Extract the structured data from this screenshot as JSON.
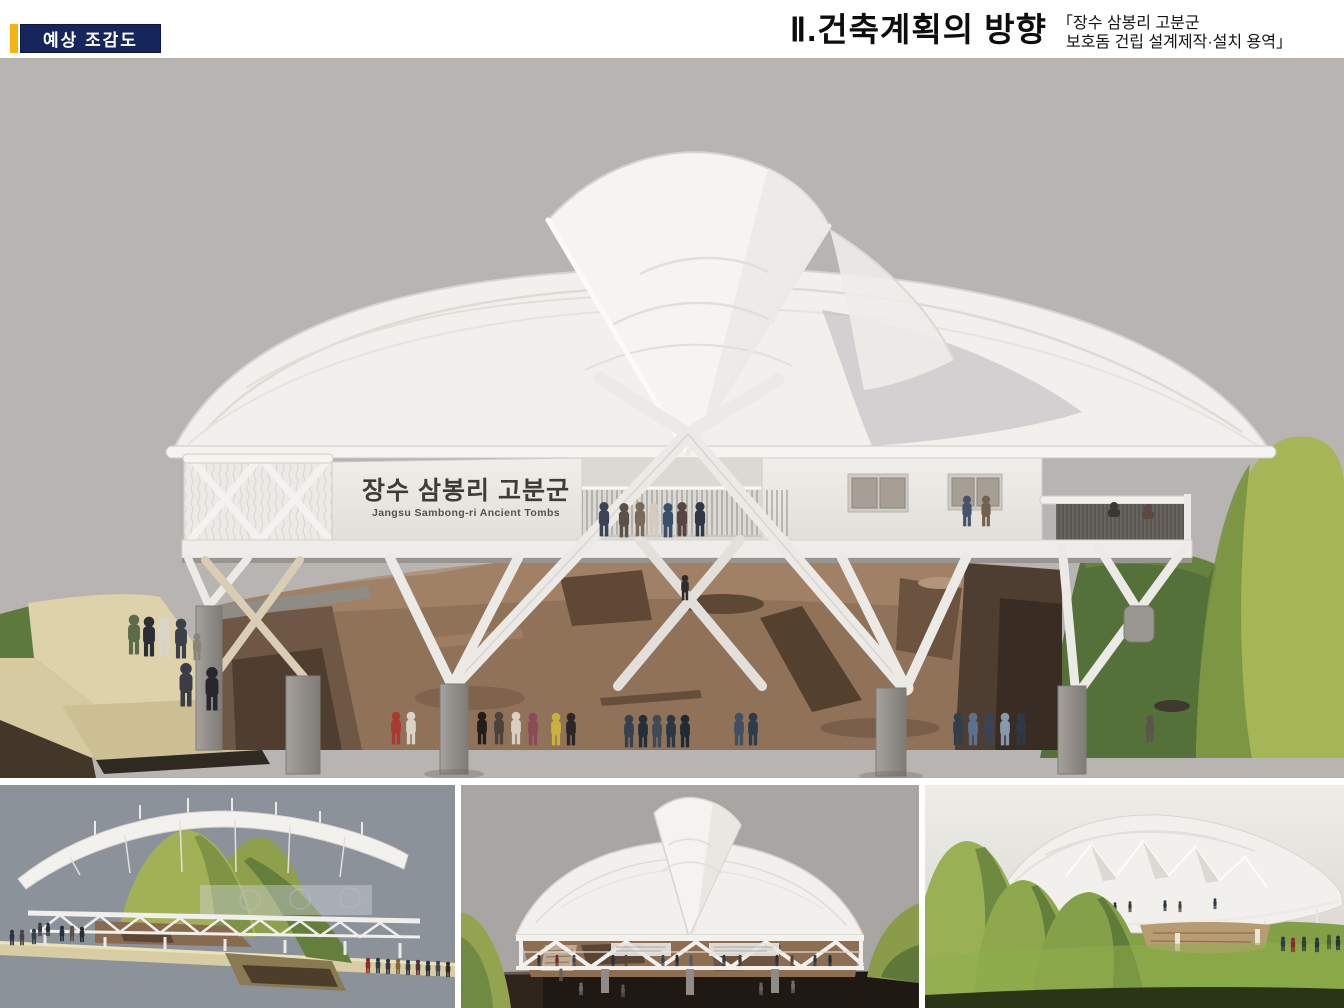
{
  "header": {
    "badge_label": "예상 조감도",
    "title": "Ⅱ.건축계획의 방향",
    "subtitle_line1": "「장수 삼봉리 고분군",
    "subtitle_line2": "보호돔 건립 설계제작·설치 용역」"
  },
  "main_render": {
    "building_sign_ko": "장수 삼봉리 고분군",
    "building_sign_en": "Jangsu Sambong-ri Ancient Tombs"
  },
  "colors": {
    "accent_gold": "#f5b411",
    "badge_navy": "#16255b",
    "render_background": "#b8b4b2",
    "dome_white": "#f2f0ed",
    "excavation_brown": "#8f7258",
    "hill_green": "#a6b657",
    "thumb_left_background": "#8b929a",
    "thumb_middle_background": "#a9a5a3",
    "thumb_right_sky": "#eeece7"
  }
}
